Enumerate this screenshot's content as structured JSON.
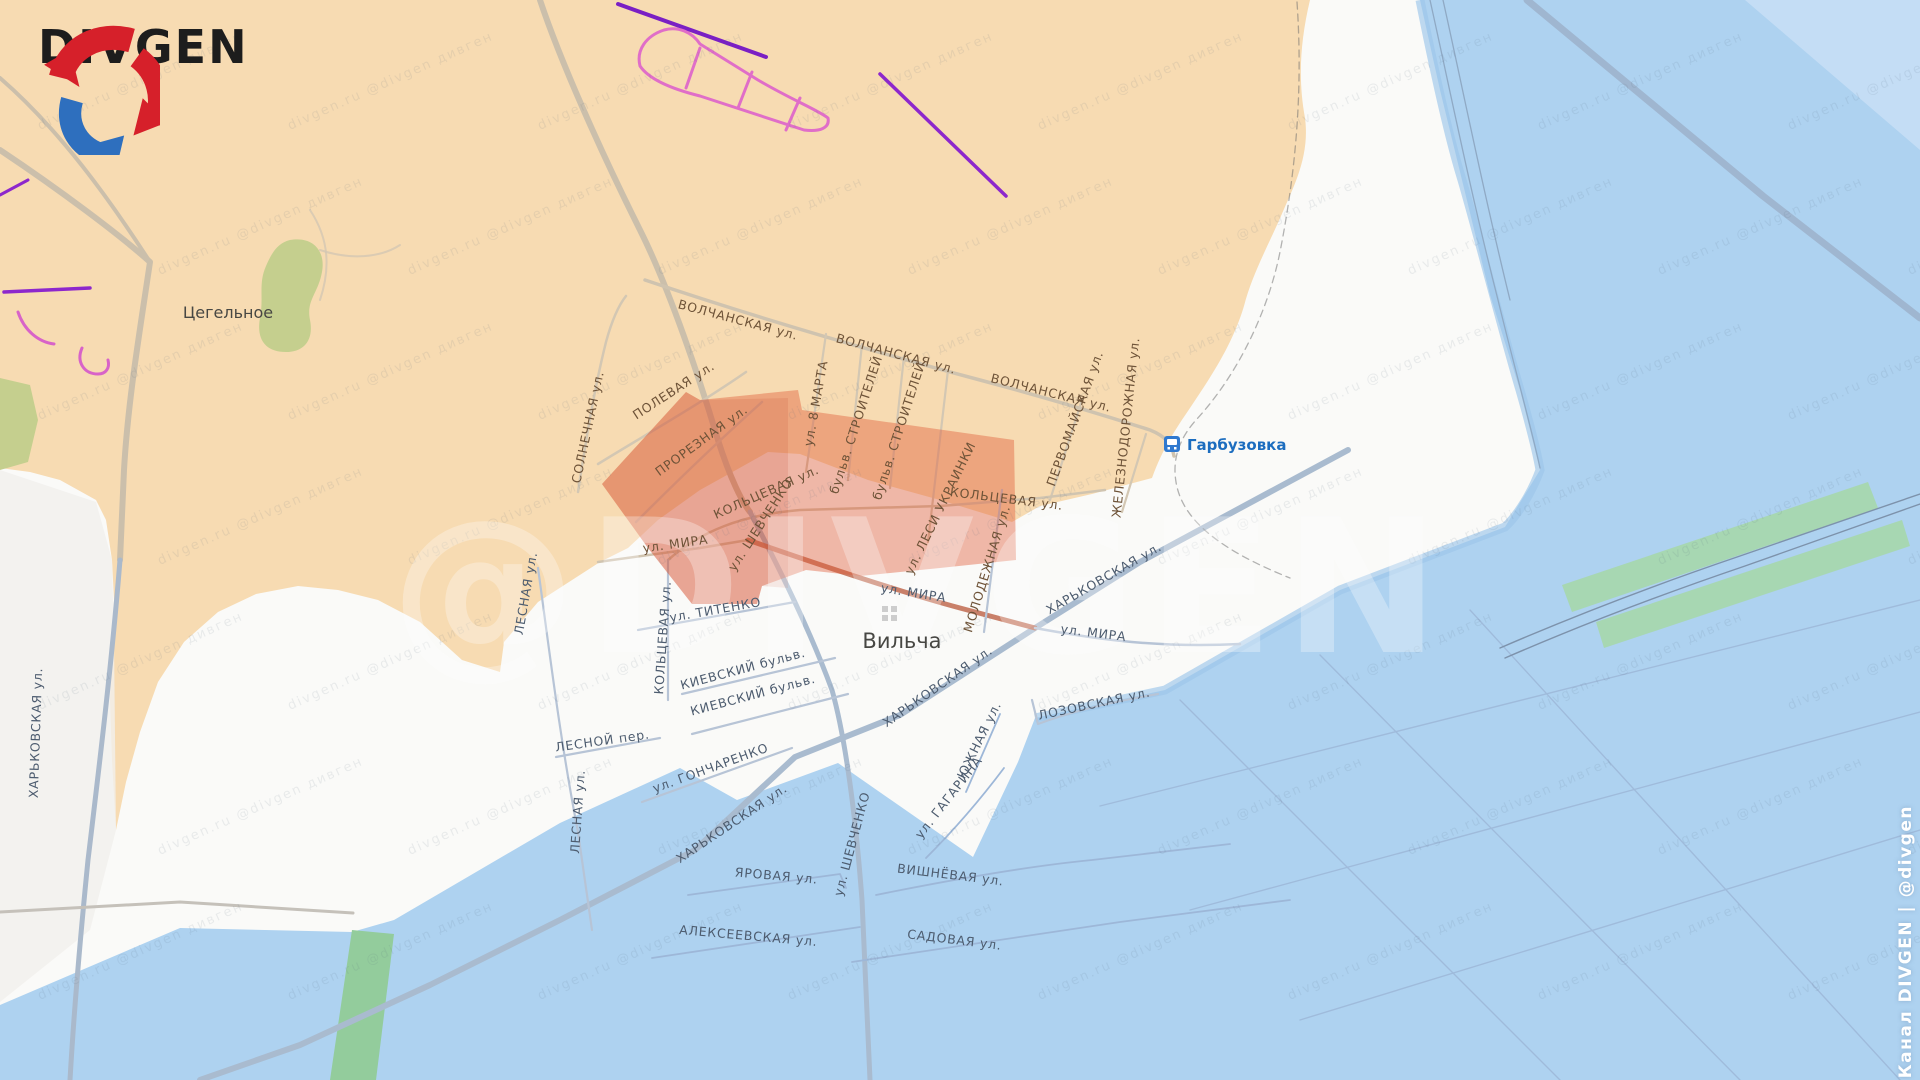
{
  "brand": {
    "logo_text": "DIVGEN",
    "channel_line": "Канал DIVGEN | @divgen",
    "watermark_large": "@DIVGEN",
    "watermark_tile": "divgen.ru  @divgen  дивген"
  },
  "map": {
    "settlements": {
      "tsegelnoe": "Цегельное",
      "vilcha": "Вильча",
      "harbuzivka": "Гарбузовка"
    },
    "street_labels": [
      "ВОЛЧАНСКАЯ ул.",
      "ВОЛЧАНСКАЯ ул.",
      "ВОЛЧАНСКАЯ ул.",
      "ПОЛЕВАЯ ул.",
      "СОЛНЕЧНАЯ ул.",
      "ПРОРЕЗНАЯ ул.",
      "ул. 8 МАРТА",
      "КОЛЬЦЕВАЯ ул.",
      "КОЛЬЦЕВАЯ ул.",
      "КОЛЬЦЕВАЯ ул.",
      "бульв. СТРОИТЕЛЕЙ",
      "бульв. СТРОИТЕЛЕЙ",
      "ул. ЛЕСИ УКРАИНКИ",
      "ПЕРВОМАЙСКАЯ ул.",
      "ЖЕЛЕЗНОДОРОЖНАЯ ул.",
      "ул. ШЕВЧЕНКО",
      "ул. ШЕВЧЕНКО",
      "ул. МИРА",
      "ул. МИРА",
      "ул. МИРА",
      "ул. ТИТЕНКО",
      "ХАРЬКОВСКАЯ ул.",
      "ХАРЬКОВСКАЯ ул.",
      "ХАРЬКОВСКАЯ ул.",
      "ХАРЬКОВСКАЯ ул.",
      "МОЛОДЕЖНАЯ ул.",
      "КИЕВСКИЙ бульв.",
      "КИЕВСКИЙ бульв.",
      "ЛЕСНОЙ пер.",
      "ул. ГОНЧАРЕНКО",
      "ЛЕСНАЯ ул.",
      "ЛЕСНАЯ ул.",
      "ЛОЗОВСКАЯ ул.",
      "ЮЖНАЯ ул.",
      "ул. ГАГАРИНА",
      "ВИШНЁВАЯ ул.",
      "САДОВАЯ ул.",
      "ЯРОВАЯ ул.",
      "АЛЕКСЕЕВСКАЯ ул."
    ]
  },
  "zones": {
    "orange_area": "#f7dbb2",
    "blue_area": "#aed2f0",
    "neutral_area": "#fafaf8",
    "red_highlight": "#e05a36",
    "forest_green": "#c5cf8e",
    "strip_green": "#9fd3a6",
    "assault_purple": "#8d27cc",
    "trench_pink": "#e06ec8"
  }
}
